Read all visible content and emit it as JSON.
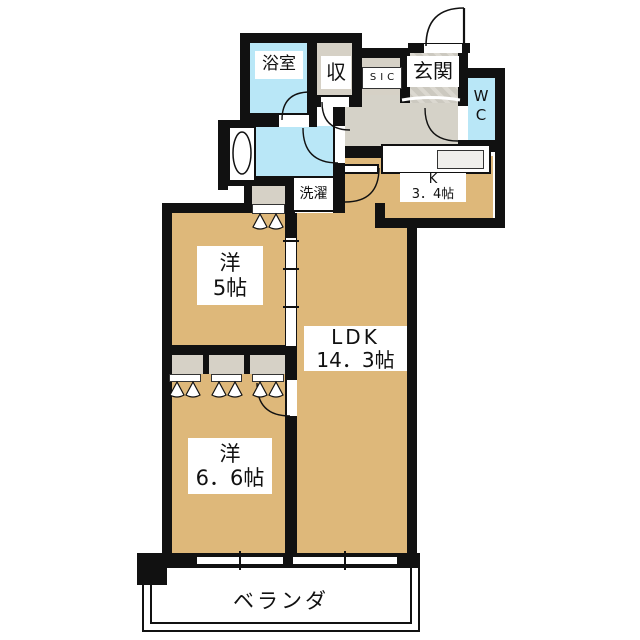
{
  "plan": {
    "title": "2LDK apartment floor plan",
    "rooms": {
      "bath": {
        "label": "浴室"
      },
      "storage": {
        "label": "収"
      },
      "sic": {
        "label": "SIC"
      },
      "entrance": {
        "label": "玄関"
      },
      "wc": {
        "line1": "W",
        "line2": "C"
      },
      "laundry": {
        "label": "洗濯"
      },
      "kitchen": {
        "name": "K",
        "size": "3．4帖"
      },
      "western5": {
        "name": "洋",
        "size": "5帖"
      },
      "ldk": {
        "name": "LDK",
        "size": "14．3帖"
      },
      "western66": {
        "name": "洋",
        "size": "6．6帖"
      },
      "veranda": {
        "label": "ベランダ"
      }
    },
    "colors": {
      "floor_wood": "#deb87a",
      "wet_area": "#b9e7f7",
      "hallway": "#d5d2c8",
      "closet": "#d6d1c6",
      "wall": "#111111",
      "background": "#ffffff"
    }
  }
}
